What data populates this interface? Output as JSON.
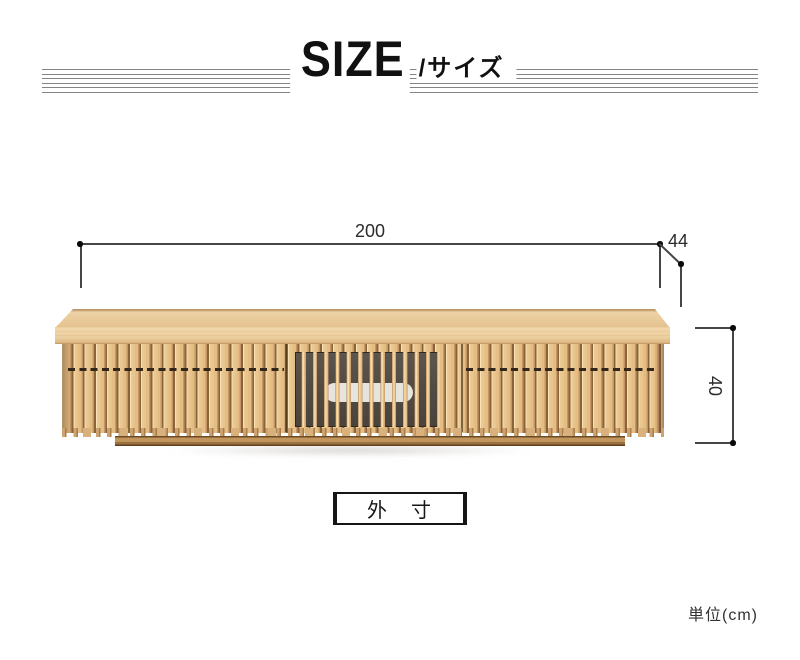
{
  "header": {
    "title": "SIZE",
    "subtitle": "/サイズ"
  },
  "dimensions": {
    "width": "200",
    "depth": "44",
    "height": "40"
  },
  "caption": "外　寸",
  "unit_label": "単位(cm)",
  "figure": {
    "kind": "tv-board front elevation",
    "sections": [
      "left-drawers",
      "center-glass-door",
      "right-drawers"
    ]
  },
  "colors": {
    "wood_top": "#ecd0a4",
    "wood_slat": "#e7c38c",
    "wood_gap": "#8a6337",
    "plinth": "#c1955c",
    "glass": "#544d46",
    "pill_cutout": "#e6e4df",
    "dim_line": "#454545",
    "header_rule": "#848484"
  }
}
